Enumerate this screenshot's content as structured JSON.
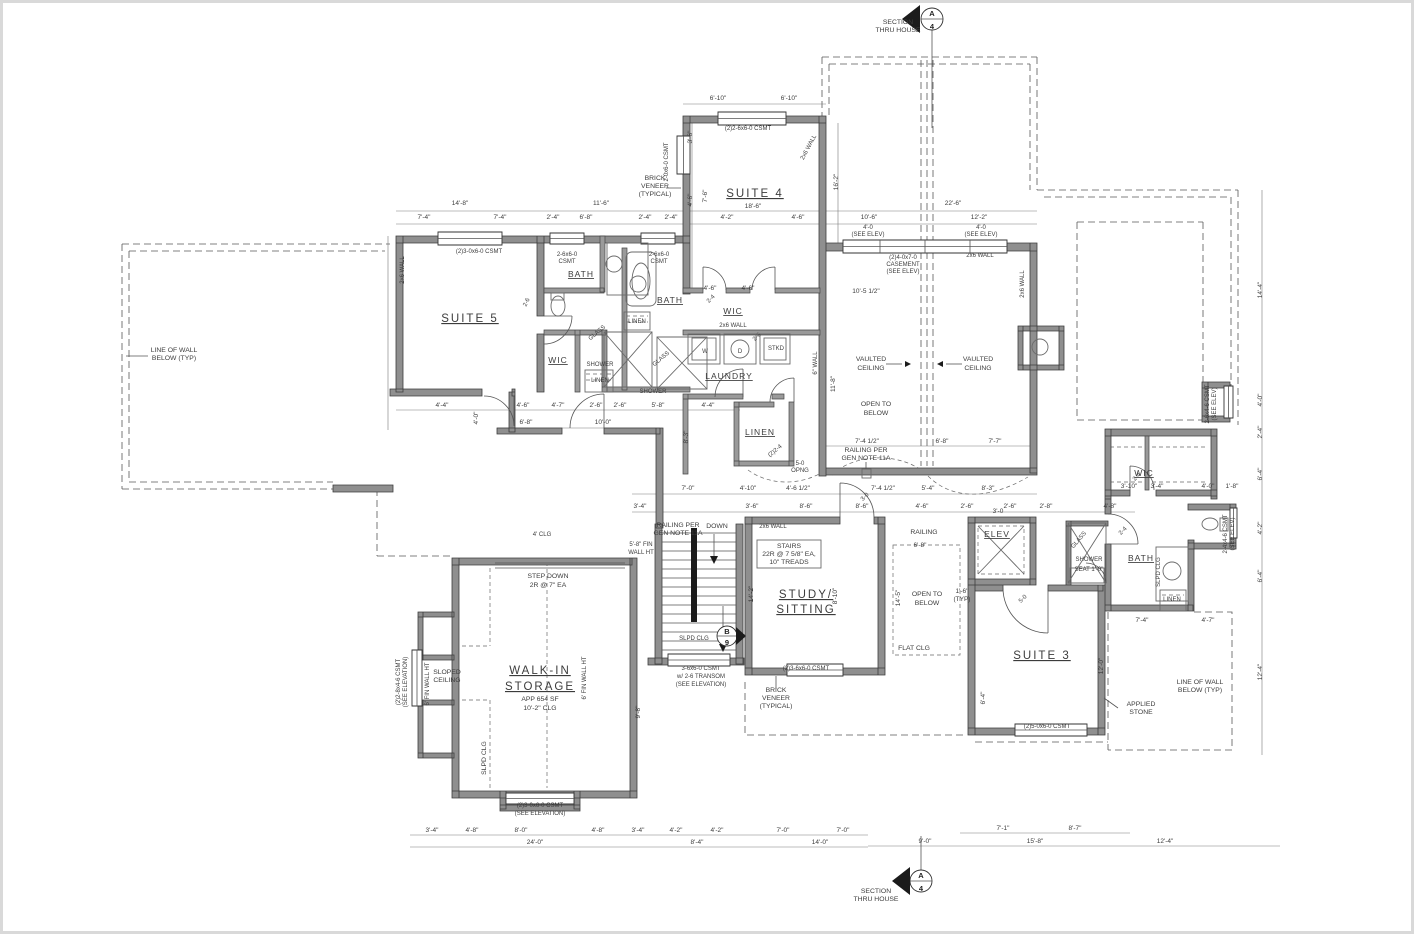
{
  "colors": {
    "wall_fill": "#8f8f8f",
    "line": "#3c3c3c",
    "dashed": "#585858",
    "background": "#ffffff"
  },
  "markers": {
    "top": {
      "letter": "A",
      "sheet": "4"
    },
    "bottom": {
      "letter": "A",
      "sheet": "4"
    },
    "stair": {
      "letter": "B",
      "sheet": "9"
    }
  },
  "labels": [
    {
      "t": "SUITE 5",
      "x": 470,
      "y": 322,
      "c": "room",
      "n": "room-label-suite-5"
    },
    {
      "t": "SUITE 4",
      "x": 755,
      "y": 197,
      "c": "room",
      "n": "room-label-suite-4"
    },
    {
      "t": "SUITE 3",
      "x": 1042,
      "y": 659,
      "c": "room",
      "n": "room-label-suite-3"
    },
    {
      "t": "BATH",
      "x": 581,
      "y": 277,
      "c": "room2",
      "n": "room-label-bath-1"
    },
    {
      "t": "BATH",
      "x": 670,
      "y": 303,
      "c": "room2",
      "n": "room-label-bath-2"
    },
    {
      "t": "BATH",
      "x": 1141,
      "y": 561,
      "c": "room2",
      "n": "room-label-bath-3"
    },
    {
      "t": "WIC",
      "x": 558,
      "y": 363,
      "c": "room2",
      "n": "room-label-wic-1"
    },
    {
      "t": "WIC",
      "x": 733,
      "y": 314,
      "c": "room2",
      "n": "room-label-wic-2"
    },
    {
      "t": "WIC",
      "x": 1144,
      "y": 476,
      "c": "room2",
      "n": "room-label-wic-3"
    },
    {
      "t": "LAUNDRY",
      "x": 729,
      "y": 379,
      "c": "room2",
      "n": "room-label-laundry"
    },
    {
      "t": "LINEN",
      "x": 760,
      "y": 435,
      "c": "room2",
      "n": "room-label-linen-main"
    },
    {
      "t": "ELEV",
      "x": 997,
      "y": 537,
      "c": "room2",
      "n": "room-label-elev"
    },
    {
      "t": "STUDY/",
      "x": 806,
      "y": 598,
      "c": "room",
      "n": "room-label-study"
    },
    {
      "t": "SITTING",
      "x": 806,
      "y": 613,
      "c": "room"
    },
    {
      "t": "WALK-IN",
      "x": 540,
      "y": 674,
      "c": "room",
      "n": "room-label-walkin-storage"
    },
    {
      "t": "STORAGE",
      "x": 540,
      "y": 690,
      "c": "room"
    },
    {
      "t": "APP 654 SF",
      "x": 540,
      "y": 701,
      "c": "sub"
    },
    {
      "t": "10'-2\" CLG",
      "x": 540,
      "y": 710,
      "c": "sub"
    },
    {
      "t": "LINEN",
      "x": 600,
      "y": 382,
      "c": "tiny"
    },
    {
      "t": "LINEN",
      "x": 637,
      "y": 323,
      "c": "tiny"
    },
    {
      "t": "LINEN",
      "x": 1172,
      "y": 601,
      "c": "tiny"
    },
    {
      "t": "SHOWER",
      "x": 600,
      "y": 366,
      "c": "tiny"
    },
    {
      "t": "SHOWER",
      "x": 653,
      "y": 393,
      "c": "tiny"
    },
    {
      "t": "SHOWER",
      "x": 1089,
      "y": 561,
      "c": "tiny"
    },
    {
      "t": "SEAT 1'-0\"",
      "x": 1089,
      "y": 571,
      "c": "tiny"
    },
    {
      "t": "GLASS",
      "x": 598,
      "y": 334,
      "c": "tiny",
      "r": -40
    },
    {
      "t": "GLASS",
      "x": 662,
      "y": 360,
      "c": "tiny",
      "r": -40
    },
    {
      "t": "GLASS",
      "x": 1080,
      "y": 541,
      "c": "tiny",
      "r": -50
    },
    {
      "t": "W",
      "x": 705,
      "y": 353,
      "c": "tiny"
    },
    {
      "t": "D",
      "x": 740,
      "y": 353,
      "c": "tiny"
    },
    {
      "t": "STKD",
      "x": 776,
      "y": 350,
      "c": "tiny"
    },
    {
      "t": "SECTION",
      "x": 898,
      "y": 24,
      "c": "ann",
      "n": "section-note-top"
    },
    {
      "t": "THRU HOUSE",
      "x": 898,
      "y": 32,
      "c": "ann"
    },
    {
      "t": "SECTION",
      "x": 876,
      "y": 893,
      "c": "ann",
      "n": "section-note-bottom"
    },
    {
      "t": "THRU HOUSE",
      "x": 876,
      "y": 901,
      "c": "ann"
    },
    {
      "t": "BRICK",
      "x": 655,
      "y": 180,
      "c": "ann"
    },
    {
      "t": "VENEER",
      "x": 655,
      "y": 188,
      "c": "ann"
    },
    {
      "t": "(TYPICAL)",
      "x": 655,
      "y": 196,
      "c": "ann"
    },
    {
      "t": "BRICK",
      "x": 776,
      "y": 692,
      "c": "ann"
    },
    {
      "t": "VENEER",
      "x": 776,
      "y": 700,
      "c": "ann"
    },
    {
      "t": "(TYPICAL)",
      "x": 776,
      "y": 708,
      "c": "ann"
    },
    {
      "t": "LINE OF WALL",
      "x": 174,
      "y": 352,
      "c": "ann"
    },
    {
      "t": "BELOW (TYP)",
      "x": 174,
      "y": 360,
      "c": "ann"
    },
    {
      "t": "LINE OF WALL",
      "x": 1200,
      "y": 684,
      "c": "ann"
    },
    {
      "t": "BELOW (TYP)",
      "x": 1200,
      "y": 692,
      "c": "ann"
    },
    {
      "t": "APPLIED",
      "x": 1141,
      "y": 706,
      "c": "ann"
    },
    {
      "t": "STONE",
      "x": 1141,
      "y": 714,
      "c": "ann"
    },
    {
      "t": "VAULTED",
      "x": 871,
      "y": 361,
      "c": "ann"
    },
    {
      "t": "CEILING",
      "x": 871,
      "y": 370,
      "c": "ann"
    },
    {
      "t": "VAULTED",
      "x": 978,
      "y": 361,
      "c": "ann"
    },
    {
      "t": "CEILING",
      "x": 978,
      "y": 370,
      "c": "ann"
    },
    {
      "t": "OPEN TO",
      "x": 876,
      "y": 406,
      "c": "ann"
    },
    {
      "t": "BELOW",
      "x": 876,
      "y": 415,
      "c": "ann"
    },
    {
      "t": "OPEN TO",
      "x": 927,
      "y": 596,
      "c": "ann"
    },
    {
      "t": "BELOW",
      "x": 927,
      "y": 605,
      "c": "ann"
    },
    {
      "t": "FLAT CLG",
      "x": 914,
      "y": 650,
      "c": "ann"
    },
    {
      "t": "RAILING PER",
      "x": 866,
      "y": 452,
      "c": "ann"
    },
    {
      "t": "GEN NOTE 11A",
      "x": 866,
      "y": 460,
      "c": "ann"
    },
    {
      "t": "RAILING PER",
      "x": 678,
      "y": 527,
      "c": "ann"
    },
    {
      "t": "GEN NOTE 11A",
      "x": 678,
      "y": 535,
      "c": "ann"
    },
    {
      "t": "RAILING",
      "x": 924,
      "y": 534,
      "c": "ann"
    },
    {
      "t": "DOWN",
      "x": 717,
      "y": 528,
      "c": "ann"
    },
    {
      "t": "STEP DOWN",
      "x": 548,
      "y": 578,
      "c": "ann"
    },
    {
      "t": "2R @ 7\" EA",
      "x": 548,
      "y": 587,
      "c": "ann"
    },
    {
      "t": "STAIRS",
      "x": 789,
      "y": 548,
      "c": "ann"
    },
    {
      "t": "22R @ 7 5/8\" EA,",
      "x": 789,
      "y": 556,
      "c": "ann"
    },
    {
      "t": "10\" TREADS",
      "x": 789,
      "y": 564,
      "c": "ann"
    },
    {
      "t": "5-0",
      "x": 800,
      "y": 465,
      "c": "tiny"
    },
    {
      "t": "OPNG",
      "x": 800,
      "y": 472,
      "c": "tiny"
    },
    {
      "t": "SLOPED",
      "x": 447,
      "y": 674,
      "c": "ann"
    },
    {
      "t": "CEILING",
      "x": 447,
      "y": 682,
      "c": "ann"
    },
    {
      "t": "SLPD CLG",
      "x": 486,
      "y": 758,
      "c": "ann",
      "r": -90
    },
    {
      "t": "SLPD CLG",
      "x": 694,
      "y": 640,
      "c": "tiny"
    },
    {
      "t": "SLPD CLG",
      "x": 1160,
      "y": 572,
      "c": "tiny",
      "r": -90
    },
    {
      "t": "6' FIN WALL HT",
      "x": 429,
      "y": 684,
      "c": "tiny",
      "r": -90
    },
    {
      "t": "6' FIN WALL HT",
      "x": 586,
      "y": 678,
      "c": "tiny",
      "r": -90
    },
    {
      "t": "5'-8\" FIN",
      "x": 641,
      "y": 546,
      "c": "tiny"
    },
    {
      "t": "WALL HT",
      "x": 641,
      "y": 554,
      "c": "tiny"
    },
    {
      "t": "4' CLG",
      "x": 542,
      "y": 536,
      "c": "tiny"
    },
    {
      "t": "2x6 WALL",
      "x": 404,
      "y": 270,
      "c": "tiny",
      "r": -90
    },
    {
      "t": "2x6 WALL",
      "x": 810,
      "y": 148,
      "c": "tiny",
      "r": -62
    },
    {
      "t": "2x6 WALL",
      "x": 980,
      "y": 257,
      "c": "tiny"
    },
    {
      "t": "2x6 WALL",
      "x": 1024,
      "y": 284,
      "c": "tiny",
      "r": -90
    },
    {
      "t": "2x6 WALL",
      "x": 733,
      "y": 327,
      "c": "tiny"
    },
    {
      "t": "2x6 WALL",
      "x": 773,
      "y": 528,
      "c": "tiny"
    },
    {
      "t": "6\" WALL",
      "x": 817,
      "y": 363,
      "c": "tiny",
      "r": -90
    },
    {
      "t": "(2)3-0x6-0 CSMT",
      "x": 479,
      "y": 253,
      "c": "tiny"
    },
    {
      "t": "2-6x6-0",
      "x": 567,
      "y": 256,
      "c": "tiny"
    },
    {
      "t": "CSMT",
      "x": 567,
      "y": 263,
      "c": "tiny"
    },
    {
      "t": "2-6x6-0",
      "x": 659,
      "y": 256,
      "c": "tiny"
    },
    {
      "t": "CSMT",
      "x": 659,
      "y": 263,
      "c": "tiny"
    },
    {
      "t": "2-0x6-0 CSMT",
      "x": 668,
      "y": 162,
      "c": "tiny",
      "r": -90
    },
    {
      "t": "(2)2-6x6-0 CSMT",
      "x": 748,
      "y": 130,
      "c": "tiny"
    },
    {
      "t": "4'-0",
      "x": 868,
      "y": 229,
      "c": "tiny"
    },
    {
      "t": "(SEE ELEV)",
      "x": 868,
      "y": 236,
      "c": "tiny"
    },
    {
      "t": "4'-0",
      "x": 981,
      "y": 229,
      "c": "tiny"
    },
    {
      "t": "(SEE ELEV)",
      "x": 981,
      "y": 236,
      "c": "tiny"
    },
    {
      "t": "(2)4-0x7-0",
      "x": 903,
      "y": 259,
      "c": "tiny"
    },
    {
      "t": "CASEMENT",
      "x": 903,
      "y": 266,
      "c": "tiny"
    },
    {
      "t": "(SEE ELEV)",
      "x": 903,
      "y": 273,
      "c": "tiny"
    },
    {
      "t": "(2)2-8x4-6 CSMT",
      "x": 400,
      "y": 682,
      "c": "tiny",
      "r": -90
    },
    {
      "t": "(SEE ELEVATION)",
      "x": 407,
      "y": 682,
      "c": "tiny",
      "r": -90
    },
    {
      "t": "(2)3-0x6-0 CSMT",
      "x": 540,
      "y": 807,
      "c": "tiny"
    },
    {
      "t": "(SEE ELEVATION)",
      "x": 540,
      "y": 815,
      "c": "tiny"
    },
    {
      "t": "3-6x6-0 CSMT",
      "x": 701,
      "y": 670,
      "c": "tiny"
    },
    {
      "t": "w/ 2-6 TRANSOM",
      "x": 701,
      "y": 678,
      "c": "tiny"
    },
    {
      "t": "(SEE ELEVATION)",
      "x": 701,
      "y": 686,
      "c": "tiny"
    },
    {
      "t": "(2)3-6x6-0 CSMT",
      "x": 806,
      "y": 670,
      "c": "tiny"
    },
    {
      "t": "(2)5-0x6-0 CSMT",
      "x": 1047,
      "y": 728,
      "c": "tiny"
    },
    {
      "t": "2-6x4-6 CSMT",
      "x": 1209,
      "y": 404,
      "c": "tiny",
      "r": -90
    },
    {
      "t": "(SEE ELEV)",
      "x": 1216,
      "y": 404,
      "c": "tiny",
      "r": -90
    },
    {
      "t": "2-4x4-6 CSMT",
      "x": 1227,
      "y": 534,
      "c": "tiny",
      "r": -90
    },
    {
      "t": "(SEE ELEV)",
      "x": 1234,
      "y": 534,
      "c": "tiny",
      "r": -90
    },
    {
      "t": "2-6",
      "x": 528,
      "y": 303,
      "c": "tiny",
      "r": -65
    },
    {
      "t": "2-4",
      "x": 712,
      "y": 300,
      "c": "tiny",
      "r": -45
    },
    {
      "t": "2-6",
      "x": 758,
      "y": 338,
      "c": "tiny",
      "r": -45
    },
    {
      "t": "(2)2-4",
      "x": 776,
      "y": 452,
      "c": "tiny",
      "r": -40
    },
    {
      "t": "3-0",
      "x": 866,
      "y": 498,
      "c": "tiny",
      "r": -45
    },
    {
      "t": "5-0",
      "x": 1024,
      "y": 600,
      "c": "tiny",
      "r": -45
    },
    {
      "t": "2-4",
      "x": 1124,
      "y": 532,
      "c": "tiny",
      "r": -45
    },
    {
      "t": "2-4",
      "x": 1138,
      "y": 478,
      "c": "tiny",
      "r": -45
    },
    {
      "t": "6'-10\"",
      "x": 718,
      "y": 100,
      "c": "dim"
    },
    {
      "t": "6'-10\"",
      "x": 789,
      "y": 100,
      "c": "dim"
    },
    {
      "t": "14'-8\"",
      "x": 460,
      "y": 205,
      "c": "dim"
    },
    {
      "t": "11'-6\"",
      "x": 601,
      "y": 205,
      "c": "dim"
    },
    {
      "t": "22'-6\"",
      "x": 953,
      "y": 205,
      "c": "dim"
    },
    {
      "t": "7'-4\"",
      "x": 424,
      "y": 219,
      "c": "dim"
    },
    {
      "t": "7'-4\"",
      "x": 500,
      "y": 219,
      "c": "dim"
    },
    {
      "t": "2'-4\"",
      "x": 553,
      "y": 219,
      "c": "dim"
    },
    {
      "t": "6'-8\"",
      "x": 586,
      "y": 219,
      "c": "dim"
    },
    {
      "t": "2'-4\"",
      "x": 645,
      "y": 219,
      "c": "dim"
    },
    {
      "t": "2'-4\"",
      "x": 671,
      "y": 219,
      "c": "dim"
    },
    {
      "t": "18'-6\"",
      "x": 753,
      "y": 208,
      "c": "dim"
    },
    {
      "t": "4'-2\"",
      "x": 727,
      "y": 219,
      "c": "dim"
    },
    {
      "t": "4'-6\"",
      "x": 798,
      "y": 219,
      "c": "dim"
    },
    {
      "t": "10'-6\"",
      "x": 869,
      "y": 219,
      "c": "dim"
    },
    {
      "t": "12'-2\"",
      "x": 979,
      "y": 219,
      "c": "dim"
    },
    {
      "t": "10'-5 1/2\"",
      "x": 866,
      "y": 293,
      "c": "dim"
    },
    {
      "t": "3'-6\"",
      "x": 692,
      "y": 137,
      "c": "dim",
      "r": -90
    },
    {
      "t": "4'-6\"",
      "x": 692,
      "y": 200,
      "c": "dim",
      "r": -90
    },
    {
      "t": "16'-2\"",
      "x": 838,
      "y": 182,
      "c": "dim",
      "r": -90
    },
    {
      "t": "7'-6\"",
      "x": 707,
      "y": 196,
      "c": "dim",
      "r": -90
    },
    {
      "t": "14'-4\"",
      "x": 1262,
      "y": 290,
      "c": "dim",
      "r": -90
    },
    {
      "t": "4'-0\"",
      "x": 1262,
      "y": 400,
      "c": "dim",
      "r": -90
    },
    {
      "t": "2'-4\"",
      "x": 1262,
      "y": 432,
      "c": "dim",
      "r": -90
    },
    {
      "t": "6'-4\"",
      "x": 1262,
      "y": 474,
      "c": "dim",
      "r": -90
    },
    {
      "t": "4'-2\"",
      "x": 1262,
      "y": 528,
      "c": "dim",
      "r": -90
    },
    {
      "t": "6'-4\"",
      "x": 1262,
      "y": 576,
      "c": "dim",
      "r": -90
    },
    {
      "t": "12'-4\"",
      "x": 1262,
      "y": 672,
      "c": "dim",
      "r": -90
    },
    {
      "t": "4'-4\"",
      "x": 442,
      "y": 407,
      "c": "dim"
    },
    {
      "t": "4'-6\"",
      "x": 523,
      "y": 407,
      "c": "dim"
    },
    {
      "t": "4'-7\"",
      "x": 558,
      "y": 407,
      "c": "dim"
    },
    {
      "t": "2'-6\"",
      "x": 596,
      "y": 407,
      "c": "dim"
    },
    {
      "t": "2'-6\"",
      "x": 620,
      "y": 407,
      "c": "dim"
    },
    {
      "t": "5'-8\"",
      "x": 658,
      "y": 407,
      "c": "dim"
    },
    {
      "t": "4'-4\"",
      "x": 708,
      "y": 407,
      "c": "dim"
    },
    {
      "t": "4'-0\"",
      "x": 478,
      "y": 418,
      "c": "dim",
      "r": -90
    },
    {
      "t": "6'-8\"",
      "x": 526,
      "y": 424,
      "c": "dim"
    },
    {
      "t": "10'-0\"",
      "x": 603,
      "y": 424,
      "c": "dim"
    },
    {
      "t": "4'-6\"",
      "x": 710,
      "y": 290,
      "c": "dim"
    },
    {
      "t": "4'-6\"",
      "x": 748,
      "y": 290,
      "c": "dim"
    },
    {
      "t": "8'-3\"",
      "x": 688,
      "y": 437,
      "c": "dim",
      "r": -90
    },
    {
      "t": "11'-8\"",
      "x": 835,
      "y": 384,
      "c": "dim",
      "r": -90
    },
    {
      "t": "7'-4 1/2\"",
      "x": 867,
      "y": 443,
      "c": "dim"
    },
    {
      "t": "6'-8\"",
      "x": 942,
      "y": 443,
      "c": "dim"
    },
    {
      "t": "7'-7\"",
      "x": 995,
      "y": 443,
      "c": "dim"
    },
    {
      "t": "7'-0\"",
      "x": 688,
      "y": 490,
      "c": "dim"
    },
    {
      "t": "4'-10\"",
      "x": 748,
      "y": 490,
      "c": "dim"
    },
    {
      "t": "4'-6 1/2\"",
      "x": 798,
      "y": 490,
      "c": "dim"
    },
    {
      "t": "7'-4 1/2\"",
      "x": 883,
      "y": 490,
      "c": "dim"
    },
    {
      "t": "5'-4\"",
      "x": 928,
      "y": 490,
      "c": "dim"
    },
    {
      "t": "8'-3\"",
      "x": 988,
      "y": 490,
      "c": "dim"
    },
    {
      "t": "3'-4\"",
      "x": 640,
      "y": 508,
      "c": "dim"
    },
    {
      "t": "3'-6\"",
      "x": 752,
      "y": 508,
      "c": "dim"
    },
    {
      "t": "8'-6\"",
      "x": 806,
      "y": 508,
      "c": "dim"
    },
    {
      "t": "8'-6\"",
      "x": 862,
      "y": 508,
      "c": "dim"
    },
    {
      "t": "4'-6\"",
      "x": 922,
      "y": 508,
      "c": "dim"
    },
    {
      "t": "2'-6\"",
      "x": 967,
      "y": 508,
      "c": "dim"
    },
    {
      "t": "2'-6\"",
      "x": 1010,
      "y": 508,
      "c": "dim"
    },
    {
      "t": "2'-8\"",
      "x": 1046,
      "y": 508,
      "c": "dim"
    },
    {
      "t": "4'-8\"",
      "x": 1110,
      "y": 508,
      "c": "dim"
    },
    {
      "t": "6'-8\"",
      "x": 920,
      "y": 547,
      "c": "dim"
    },
    {
      "t": "1'-6\"",
      "x": 962,
      "y": 593,
      "c": "dim"
    },
    {
      "t": "(TYP)",
      "x": 962,
      "y": 601,
      "c": "dim"
    },
    {
      "t": "14'-5\"",
      "x": 900,
      "y": 598,
      "c": "dim",
      "r": -90
    },
    {
      "t": "8'-10\"",
      "x": 837,
      "y": 596,
      "c": "dim",
      "r": -90
    },
    {
      "t": "14'-2\"",
      "x": 753,
      "y": 594,
      "c": "dim",
      "r": -90
    },
    {
      "t": "3'-0",
      "x": 998,
      "y": 513,
      "c": "dim"
    },
    {
      "t": "3'-10\"",
      "x": 1129,
      "y": 488,
      "c": "dim"
    },
    {
      "t": "3'-4\"",
      "x": 1157,
      "y": 488,
      "c": "dim"
    },
    {
      "t": "4'-0\"",
      "x": 1208,
      "y": 488,
      "c": "dim"
    },
    {
      "t": "1'-8\"",
      "x": 1232,
      "y": 488,
      "c": "dim"
    },
    {
      "t": "7'-4\"",
      "x": 1142,
      "y": 622,
      "c": "dim"
    },
    {
      "t": "4'-7\"",
      "x": 1208,
      "y": 622,
      "c": "dim"
    },
    {
      "t": "12'-0\"",
      "x": 1103,
      "y": 666,
      "c": "dim",
      "r": -90
    },
    {
      "t": "6'-4\"",
      "x": 985,
      "y": 698,
      "c": "dim",
      "r": -90
    },
    {
      "t": "9'-8\"",
      "x": 640,
      "y": 712,
      "c": "dim",
      "r": -90
    },
    {
      "t": "3'-4\"",
      "x": 432,
      "y": 832,
      "c": "dim"
    },
    {
      "t": "4'-8\"",
      "x": 472,
      "y": 832,
      "c": "dim"
    },
    {
      "t": "8'-0\"",
      "x": 521,
      "y": 832,
      "c": "dim"
    },
    {
      "t": "4'-8\"",
      "x": 598,
      "y": 832,
      "c": "dim"
    },
    {
      "t": "3'-4\"",
      "x": 638,
      "y": 832,
      "c": "dim"
    },
    {
      "t": "4'-2\"",
      "x": 676,
      "y": 832,
      "c": "dim"
    },
    {
      "t": "4'-2\"",
      "x": 717,
      "y": 832,
      "c": "dim"
    },
    {
      "t": "7'-0\"",
      "x": 783,
      "y": 832,
      "c": "dim"
    },
    {
      "t": "7'-0\"",
      "x": 843,
      "y": 832,
      "c": "dim"
    },
    {
      "t": "24'-0\"",
      "x": 535,
      "y": 844,
      "c": "dim"
    },
    {
      "t": "8'-4\"",
      "x": 697,
      "y": 844,
      "c": "dim"
    },
    {
      "t": "14'-0\"",
      "x": 820,
      "y": 844,
      "c": "dim"
    },
    {
      "t": "9'-0\"",
      "x": 925,
      "y": 843,
      "c": "dim"
    },
    {
      "t": "7'-1\"",
      "x": 1003,
      "y": 830,
      "c": "dim"
    },
    {
      "t": "8'-7\"",
      "x": 1075,
      "y": 830,
      "c": "dim"
    },
    {
      "t": "15'-8\"",
      "x": 1035,
      "y": 843,
      "c": "dim"
    },
    {
      "t": "12'-4\"",
      "x": 1165,
      "y": 843,
      "c": "dim"
    }
  ]
}
